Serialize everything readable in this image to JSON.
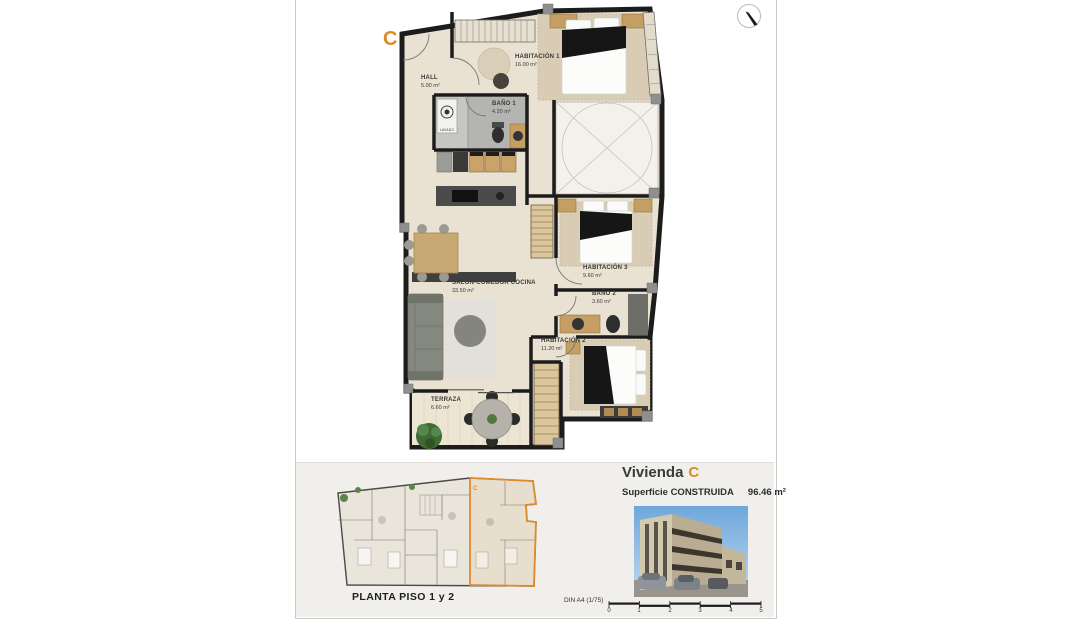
{
  "plan": {
    "unit_marker": "C",
    "rooms": [
      {
        "id": "hall",
        "name": "HALL",
        "area": "5.00 m²"
      },
      {
        "id": "habitacion1",
        "name": "HABITACIÓN 1",
        "area": "16.00 m²"
      },
      {
        "id": "bano1",
        "name": "BAÑO 1",
        "area": "4.20 m²"
      },
      {
        "id": "salon",
        "name": "SALÓN-COMEDOR COCINA",
        "area": "33.50 m²"
      },
      {
        "id": "habitacion3",
        "name": "HABITACIÓN 3",
        "area": "9.60 m²"
      },
      {
        "id": "bano2",
        "name": "BAÑO 2",
        "area": "3.60 m²"
      },
      {
        "id": "habitacion2",
        "name": "HABITACIÓN 2",
        "area": "11.20 m²"
      },
      {
        "id": "terraza",
        "name": "TERRAZA",
        "area": "6.60 m²"
      }
    ],
    "appliance_label": "LAVADO"
  },
  "footer": {
    "overview_caption": "PLANTA PISO 1 y 2",
    "overview_unit_marker": "C",
    "unit_title": "Vivienda",
    "unit_letter": "C",
    "surface_label": "Superficie CONSTRUIDA",
    "surface_value": "96.46 m²",
    "sheet_format": "DIN A4 (1/75)",
    "scale_ticks": [
      "0",
      "1",
      "2",
      "3",
      "4",
      "5"
    ]
  },
  "colors": {
    "accent": "#DD8A2B",
    "wall": "#1C1C1C",
    "floor": "#E9E1D2",
    "bath_floor": "#B4B4B0",
    "wood": "#C8A873"
  }
}
